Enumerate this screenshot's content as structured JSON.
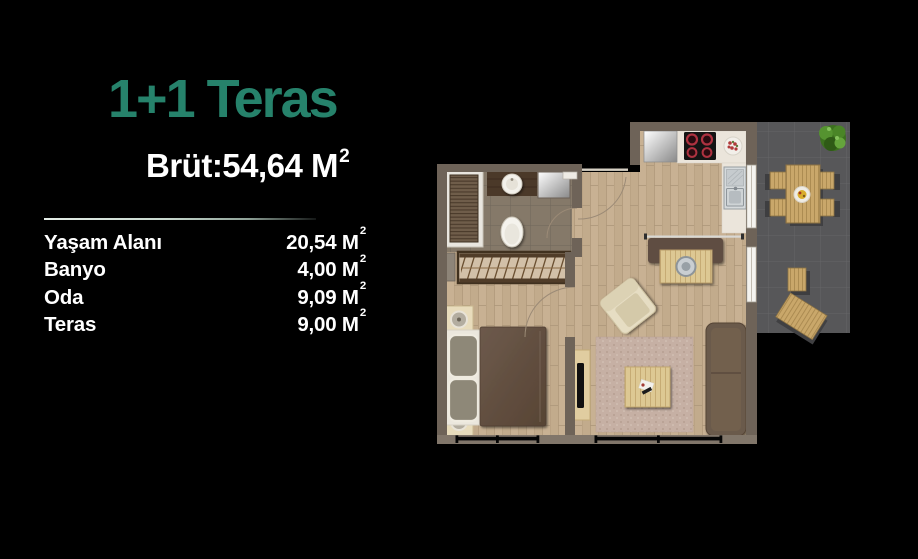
{
  "panel": {
    "title": "1+1 Teras",
    "gross": {
      "text": "Brüt:54,64 M",
      "sup": "2"
    },
    "areas": [
      {
        "label": "Yaşam Alanı",
        "value": "20,54 M",
        "sup": "2"
      },
      {
        "label": "Banyo",
        "value": "4,00 M",
        "sup": "2"
      },
      {
        "label": "Oda",
        "value": "9,09 M",
        "sup": "2"
      },
      {
        "label": "Teras",
        "value": "9,00 M",
        "sup": "2"
      }
    ]
  },
  "floorplan": {
    "type": "apartment-top-view",
    "rooms": [
      "bathroom",
      "entry-hall",
      "bedroom",
      "living-area",
      "kitchen",
      "terrace"
    ],
    "features": {
      "bathroom": [
        "shower",
        "vanity-sink",
        "glass-cabin",
        "toilet"
      ],
      "entry-hall": [
        "entry-door",
        "wardrobe"
      ],
      "bedroom": [
        "double-bed",
        "pillows",
        "nightstand-lamps",
        "bedroom-door"
      ],
      "living-area": [
        "dining-bench",
        "dining-table",
        "armchair",
        "rug",
        "coffee-table",
        "sofa",
        "tv-stand"
      ],
      "kitchen": [
        "fridge",
        "cooktop-4-burners",
        "marble-counter",
        "double-sink",
        "plate"
      ],
      "terrace": [
        "outdoor-dining-table",
        "four-chairs",
        "stool",
        "lounger",
        "plant"
      ]
    }
  },
  "colors": {
    "background": "#000000",
    "accent_teal": "#26826b",
    "text_white": "#ffffff",
    "wall": "#6e6358",
    "wood_floor": "#c8b193",
    "bathroom_tile": "#857969",
    "terrace_tile": "#575759",
    "sofa_brown": "#6b5a4c",
    "rug_pink": "#c6b0a4",
    "outdoor_wood": "#c9a76a"
  }
}
